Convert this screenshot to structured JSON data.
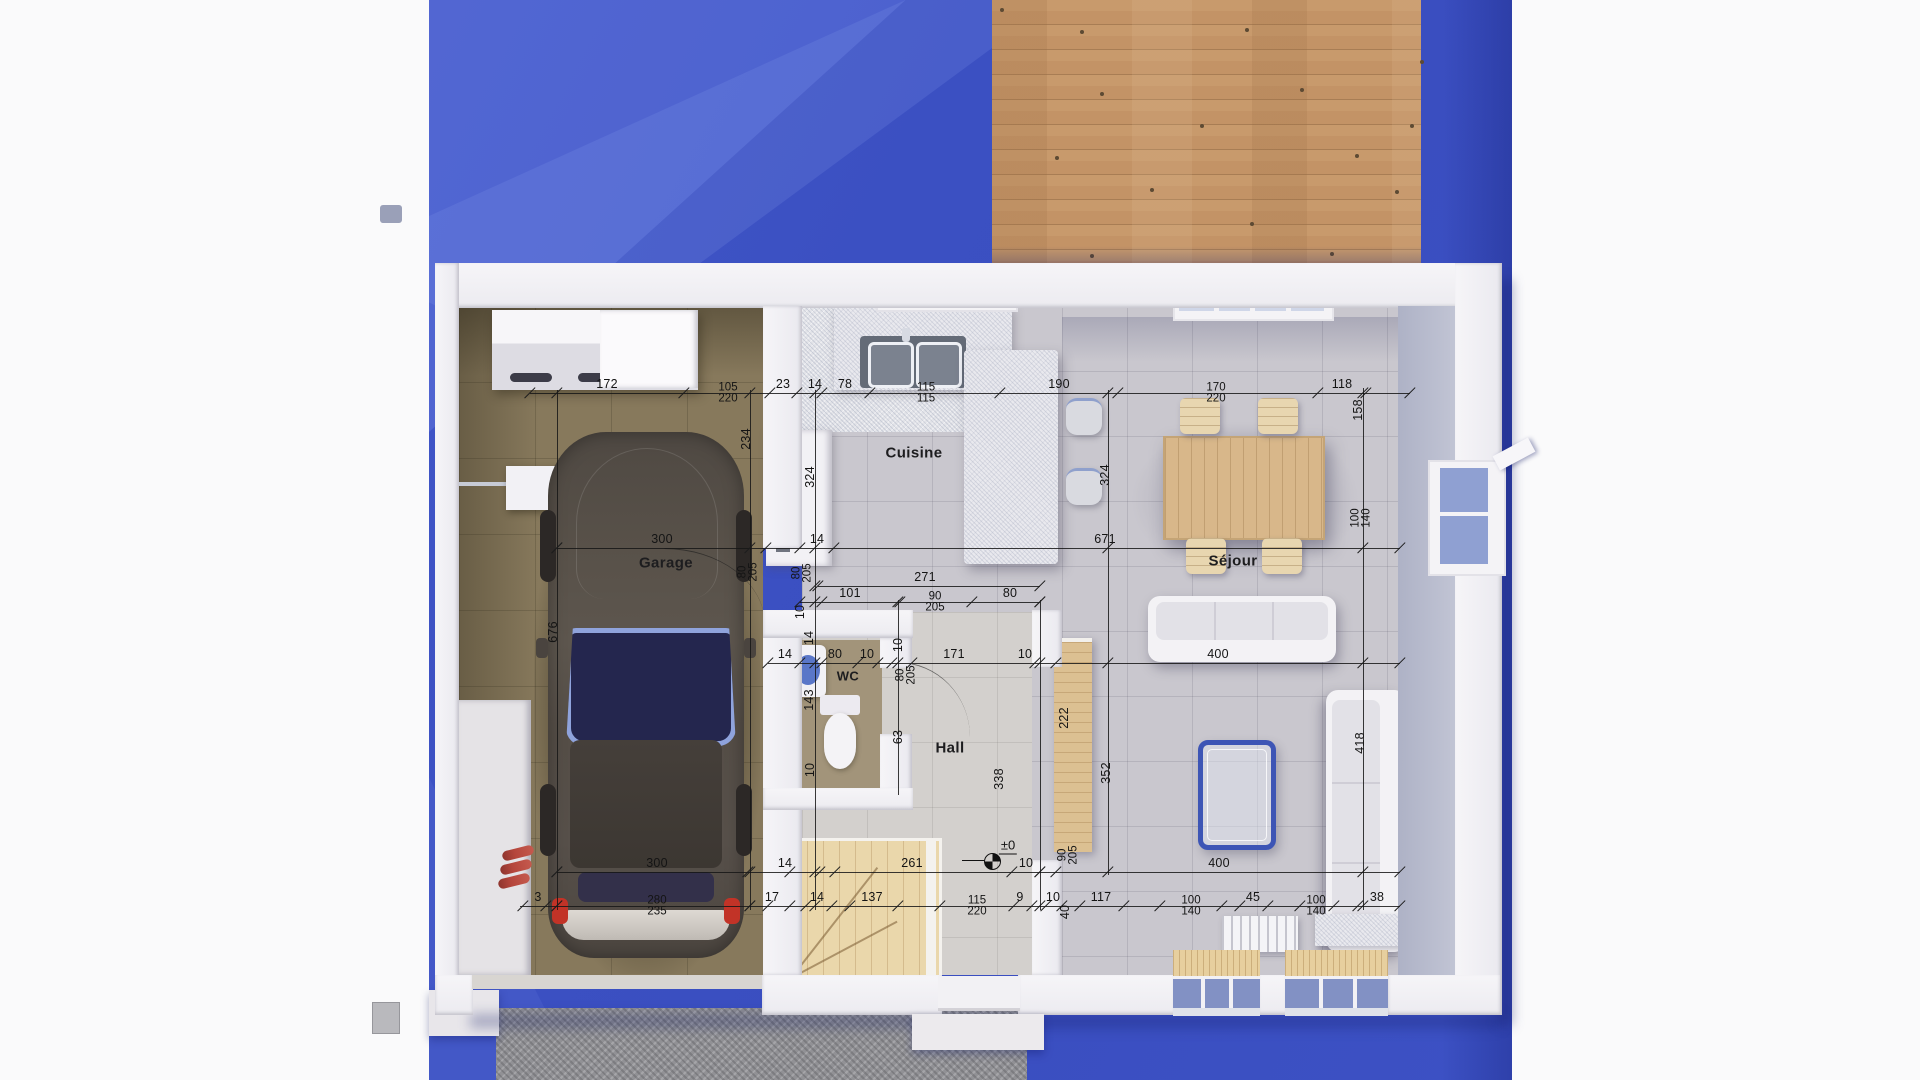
{
  "scene": {
    "background": "#fafafb",
    "ground_blue": "#3b51c3",
    "deck_wood": "#c3946a",
    "driveway_grey": "#919195",
    "wall_white": "#efedf2",
    "garage_floor": "#87795c",
    "tile_floor": "#c8c6cd",
    "accent_blue": "#3d55b5",
    "dim_color": "#1b1b1b"
  },
  "rooms": [
    {
      "id": "garage",
      "label": "Garage",
      "x": 666,
      "y": 563
    },
    {
      "id": "cuisine",
      "label": "Cuisine",
      "x": 914,
      "y": 453
    },
    {
      "id": "wc",
      "label": "WC",
      "x": 848,
      "y": 676
    },
    {
      "id": "hall",
      "label": "Hall",
      "x": 950,
      "y": 748
    },
    {
      "id": "sejour",
      "label": "Séjour",
      "x": 1233,
      "y": 561
    }
  ],
  "level_marker": {
    "text": "±0",
    "x": 1008,
    "y": 846
  },
  "dimensions": {
    "rows": [
      {
        "name": "top-chain",
        "y": 393,
        "x1": 530,
        "x2": 1410,
        "labels": [
          {
            "t": "172",
            "x": 607
          },
          {
            "t": "105",
            "b": "220",
            "x": 728
          },
          {
            "t": "23",
            "x": 783
          },
          {
            "t": "14",
            "x": 815
          },
          {
            "t": "78",
            "x": 845
          },
          {
            "t": "115",
            "b": "115",
            "x": 926
          },
          {
            "t": "190",
            "x": 1059
          },
          {
            "t": "170",
            "b": "220",
            "x": 1216
          },
          {
            "t": "118",
            "x": 1342
          }
        ],
        "ticks": [
          530,
          684,
          770,
          797,
          822,
          870,
          1000,
          1118,
          1318,
          1366,
          1410
        ]
      },
      {
        "name": "mid-chain",
        "y": 548,
        "x1": 557,
        "x2": 1400,
        "labels": [
          {
            "t": "300",
            "x": 662
          },
          {
            "t": "14",
            "x": 817
          },
          {
            "t": "671",
            "x": 1105
          }
        ],
        "ticks": [
          557,
          766,
          800,
          834,
          1400
        ]
      },
      {
        "name": "hall-width",
        "y": 586,
        "x1": 818,
        "x2": 1040,
        "labels": [
          {
            "t": "271",
            "x": 925
          }
        ],
        "ticks": [
          818,
          1040
        ]
      },
      {
        "name": "kitchen-door-chain",
        "y": 602,
        "x1": 800,
        "x2": 1040,
        "labels": [
          {
            "t": "101",
            "x": 850
          },
          {
            "t": "90",
            "b": "205",
            "x": 935
          },
          {
            "t": "80",
            "x": 1010
          }
        ],
        "ticks": [
          800,
          822,
          900,
          972,
          1040
        ]
      },
      {
        "name": "wc-hall-chain",
        "y": 663,
        "x1": 768,
        "x2": 1400,
        "labels": [
          {
            "t": "14",
            "x": 785
          },
          {
            "t": "80",
            "x": 835
          },
          {
            "t": "10",
            "x": 867
          },
          {
            "t": "171",
            "x": 954
          },
          {
            "t": "10",
            "x": 1025
          },
          {
            "t": "400",
            "x": 1218
          }
        ],
        "ticks": [
          768,
          800,
          822,
          858,
          878,
          892,
          912,
          1035,
          1056,
          1400
        ]
      },
      {
        "name": "lower-chain",
        "y": 872,
        "x1": 557,
        "x2": 1400,
        "labels": [
          {
            "t": "300",
            "x": 657
          },
          {
            "t": "14",
            "x": 785
          },
          {
            "t": "261",
            "x": 912
          },
          {
            "t": "10",
            "x": 1026
          },
          {
            "t": "400",
            "x": 1219
          }
        ],
        "ticks": [
          557,
          748,
          790,
          820,
          835,
          1012,
          1040,
          1056,
          1400
        ]
      },
      {
        "name": "bottom-chain",
        "y": 906,
        "x1": 520,
        "x2": 1400,
        "labels": [
          {
            "t": "3",
            "x": 538
          },
          {
            "t": "280",
            "b": "235",
            "x": 657
          },
          {
            "t": "17",
            "x": 772
          },
          {
            "t": "14",
            "x": 817
          },
          {
            "t": "137",
            "x": 872
          },
          {
            "t": "115",
            "b": "220",
            "x": 977
          },
          {
            "t": "9",
            "x": 1020
          },
          {
            "t": "10",
            "x": 1053
          },
          {
            "t": "117",
            "x": 1101
          },
          {
            "t": "100",
            "b": "140",
            "x": 1191
          },
          {
            "t": "45",
            "x": 1253
          },
          {
            "t": "100",
            "b": "140",
            "x": 1316
          },
          {
            "t": "38",
            "x": 1377
          }
        ],
        "ticks": [
          523,
          546,
          557,
          750,
          768,
          790,
          806,
          832,
          850,
          898,
          940,
          1014,
          1032,
          1046,
          1062,
          1080,
          1124,
          1160,
          1222,
          1240,
          1268,
          1300,
          1334,
          1358,
          1400
        ]
      }
    ],
    "vlines": [
      {
        "x": 557,
        "y1": 390,
        "y2": 910
      },
      {
        "x": 750,
        "y1": 390,
        "y2": 910
      },
      {
        "x": 815,
        "y1": 390,
        "y2": 910
      },
      {
        "x": 898,
        "y1": 600,
        "y2": 795
      },
      {
        "x": 1040,
        "y1": 600,
        "y2": 910
      },
      {
        "x": 1108,
        "y1": 390,
        "y2": 875
      },
      {
        "x": 1363,
        "y1": 388,
        "y2": 910
      }
    ],
    "vlabels": [
      {
        "t": "234",
        "x": 746,
        "y": 439
      },
      {
        "t": "324",
        "x": 810,
        "y": 477
      },
      {
        "t": "324",
        "x": 1105,
        "y": 475
      },
      {
        "t": "676",
        "x": 553,
        "y": 632
      },
      {
        "t": "158",
        "x": 1358,
        "y": 410
      },
      {
        "t": "100",
        "b": "140",
        "x": 1361,
        "y": 518
      },
      {
        "t": "80",
        "b": "205",
        "x": 748,
        "y": 572
      },
      {
        "t": "80",
        "b": "205",
        "x": 802,
        "y": 573
      },
      {
        "t": "10",
        "x": 800,
        "y": 612
      },
      {
        "t": "14",
        "x": 809,
        "y": 638
      },
      {
        "t": "10",
        "x": 898,
        "y": 645
      },
      {
        "t": "143",
        "x": 809,
        "y": 700
      },
      {
        "t": "80",
        "b": "205",
        "x": 906,
        "y": 675
      },
      {
        "t": "63",
        "x": 898,
        "y": 737
      },
      {
        "t": "10",
        "x": 810,
        "y": 770
      },
      {
        "t": "338",
        "x": 999,
        "y": 779
      },
      {
        "t": "222",
        "x": 1064,
        "y": 718
      },
      {
        "t": "352",
        "x": 1106,
        "y": 773
      },
      {
        "t": "418",
        "x": 1360,
        "y": 743
      },
      {
        "t": "90",
        "b": "205",
        "x": 1068,
        "y": 855
      },
      {
        "t": "40",
        "x": 1065,
        "y": 912
      }
    ]
  }
}
